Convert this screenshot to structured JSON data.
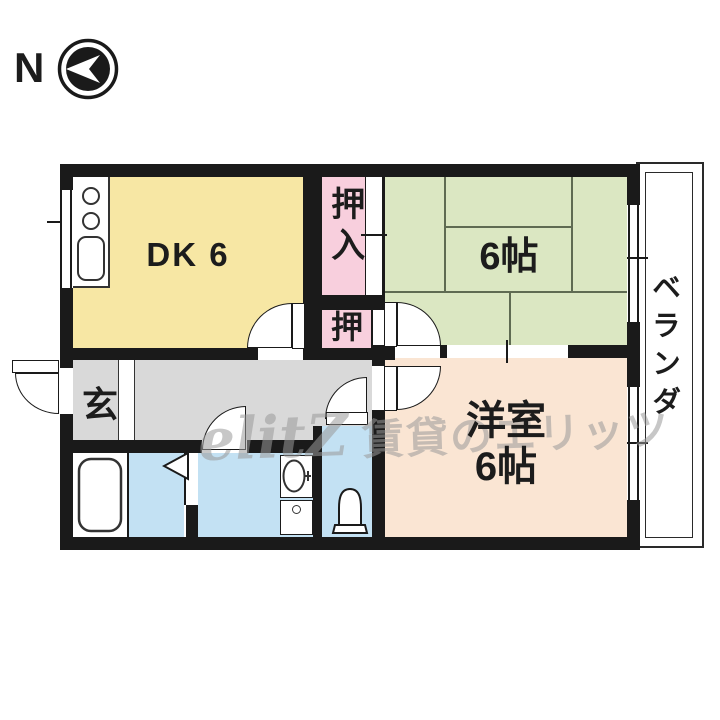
{
  "compass": {
    "north_label": "N"
  },
  "floorplan": {
    "rooms": {
      "dining_kitchen": {
        "label": "DK 6"
      },
      "closet_upper": {
        "label": "押入"
      },
      "closet_lower": {
        "label": "押"
      },
      "tatami_room": {
        "label": "6帖"
      },
      "western_room": {
        "label_line1": "洋室",
        "label_line2": "6帖"
      },
      "entrance": {
        "label": "玄"
      },
      "balcony": {
        "label": "ベランダ"
      }
    },
    "fixtures": [
      "kitchen-stove-burners",
      "kitchen-sink",
      "bathtub",
      "folding-door",
      "washbasin",
      "washing-machine",
      "toilet"
    ],
    "colors": {
      "wall": "#1a1a1a",
      "dining_kitchen": "#F7E7A4",
      "closet": "#F8CFDD",
      "tatami_room": "#DBE7C2",
      "western_room": "#FAE5D3",
      "hallway": "#D9D9D9",
      "wet_area": "#C3E1F3",
      "tatami_line": "#5F6B52"
    }
  },
  "watermark": {
    "logo": "elitZ",
    "text": "賃貸のエリッツ"
  }
}
